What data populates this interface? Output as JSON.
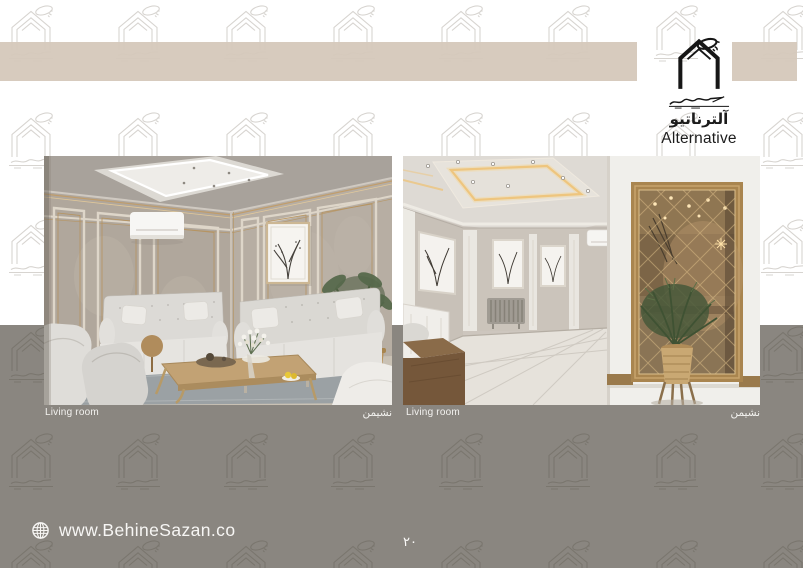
{
  "header": {
    "logo": {
      "title_fa": "آلترناتیو",
      "title_en": "Alternative",
      "icon": "behinesazan-house-logo"
    }
  },
  "gallery": {
    "items": [
      {
        "label_en": "Living room",
        "label_fa": "نشیمن"
      },
      {
        "label_en": "Living room",
        "label_fa": "نشیمن"
      }
    ]
  },
  "footer": {
    "website": "www.BehineSazan.co",
    "page_number": "۲۰",
    "icon": "globe-icon"
  },
  "colors": {
    "band": "#d5c8ba",
    "bottom_gray": "#8a8680",
    "watermark_on_white": "#d7d4d0",
    "watermark_on_gray": "#7a766e",
    "logo_ink": "#1c1c1c",
    "light_text": "#f5f4f2",
    "mirror_gold": "#a9854f"
  }
}
